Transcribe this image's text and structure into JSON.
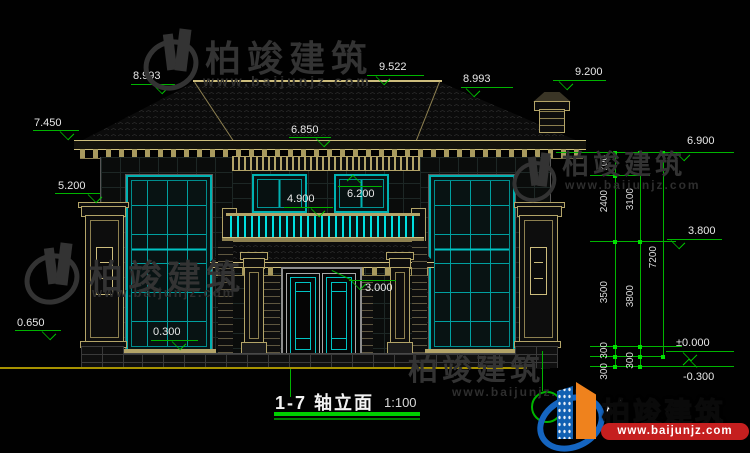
{
  "title": {
    "label": "1-7  轴立面",
    "scale": "1:100"
  },
  "watermark": {
    "brand": "柏竣建筑",
    "url": "www.baijunjz.com"
  },
  "logo": {
    "brand": "柏竣建筑",
    "url": "www.baijunjz.com",
    "brand_blue": "#1565c0",
    "brand_orange": "#ef821d",
    "strip_red": "#c51f1f"
  },
  "colors": {
    "dim_green": "#00b400",
    "frame_cyan": "#00b2b2",
    "trim_tan": "#b3a468",
    "ground_yellow": "#a79200",
    "text_white": "#e8e8e8"
  },
  "elev": {
    "roof_left_tip": "7.450",
    "pillar_top": "5.200",
    "pillar_base": "0.650",
    "ridge_left": "8.993",
    "ridge_center": "9.522",
    "ridge_right": "8.993",
    "chimney_top": "9.200",
    "eave_center": "6.850",
    "eave_right": "6.900",
    "balcony_rail": "4.900",
    "window2f_top": "6.200",
    "door_top": "3.000",
    "window_sill": "0.300",
    "floor2": "3.800",
    "floor0": "±0.000",
    "ground": "-0.300"
  },
  "dims": {
    "d700": "700",
    "d2400": "2400",
    "d3500": "3500",
    "d3100": "3100",
    "d3800": "3800",
    "d7200": "7200",
    "d300a": "300",
    "d300b": "300",
    "d300c": "300"
  }
}
